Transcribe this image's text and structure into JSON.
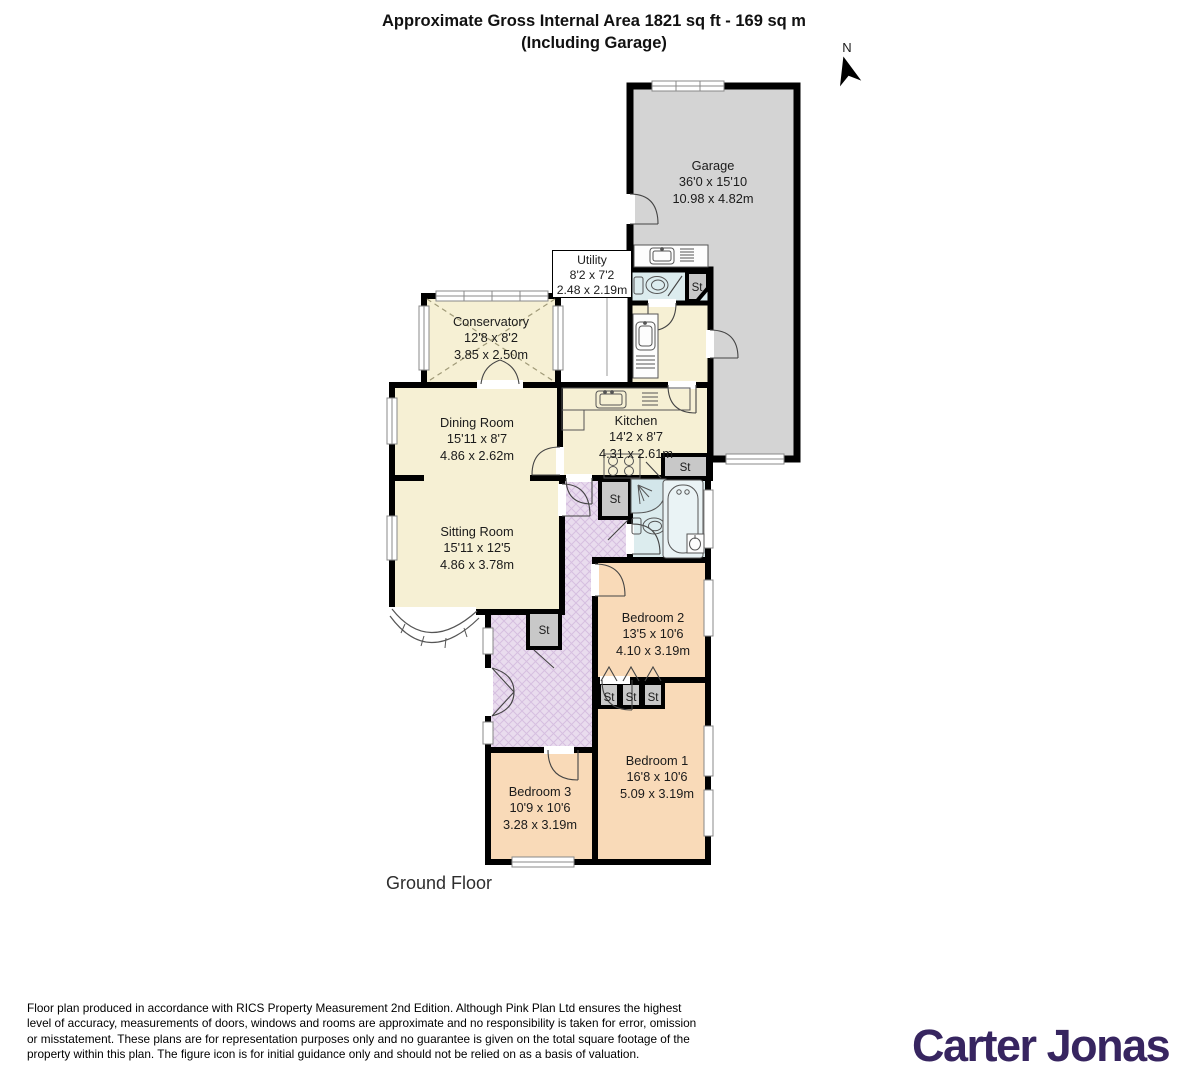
{
  "title": {
    "line1": "Approximate Gross Internal Area 1821 sq ft - 169 sq m",
    "line2": "(Including Garage)"
  },
  "compass": {
    "label": "N"
  },
  "floor": {
    "label": "Ground Floor"
  },
  "labels": {
    "storage": "St"
  },
  "rooms": [
    {
      "id": "garage",
      "name": "Garage",
      "imperial": "36'0 x 15'10",
      "metric": "10.98 x 4.82m"
    },
    {
      "id": "utility",
      "name": "Utility",
      "imperial": "8'2 x 7'2",
      "metric": "2.48 x 2.19m"
    },
    {
      "id": "conservatory",
      "name": "Conservatory",
      "imperial": "12'8 x 8'2",
      "metric": "3.85 x 2.50m"
    },
    {
      "id": "dining-room",
      "name": "Dining Room",
      "imperial": "15'11 x 8'7",
      "metric": "4.86 x 2.62m"
    },
    {
      "id": "kitchen",
      "name": "Kitchen",
      "imperial": "14'2 x 8'7",
      "metric": "4.31 x 2.61m"
    },
    {
      "id": "sitting-room",
      "name": "Sitting Room",
      "imperial": "15'11 x 12'5",
      "metric": "4.86 x 3.78m"
    },
    {
      "id": "bedroom-2",
      "name": "Bedroom 2",
      "imperial": "13'5 x 10'6",
      "metric": "4.10 x 3.19m"
    },
    {
      "id": "bedroom-1",
      "name": "Bedroom 1",
      "imperial": "16'8 x 10'6",
      "metric": "5.09 x 3.19m"
    },
    {
      "id": "bedroom-3",
      "name": "Bedroom 3",
      "imperial": "10'9 x 10'6",
      "metric": "3.28 x 3.19m"
    }
  ],
  "footer": {
    "lines": [
      "Floor plan produced in accordance with RICS Property Measurement 2nd Edition. Although Pink Plan Ltd ensures the highest",
      "level of accuracy, measurements of doors, windows and rooms are approximate and no responsibility is taken for error, omission",
      "or misstatement. These plans are for representation purposes only and no guarantee is given on the total square footage of the",
      "property within this plan. The figure icon is for initial guidance only and should not be relied on as a basis of valuation."
    ]
  },
  "brand": {
    "name": "Carter Jonas",
    "color": "#372560"
  },
  "palette": {
    "walls": "#000000",
    "garage": "#d4d4d4",
    "living": "#f6f0d4",
    "bedroom": "#f9dab8",
    "hall": "#e9dcee",
    "hall_hatch": "#d6bfe0",
    "bathroom": "#dcecee",
    "storage": "#c8c8c8"
  }
}
